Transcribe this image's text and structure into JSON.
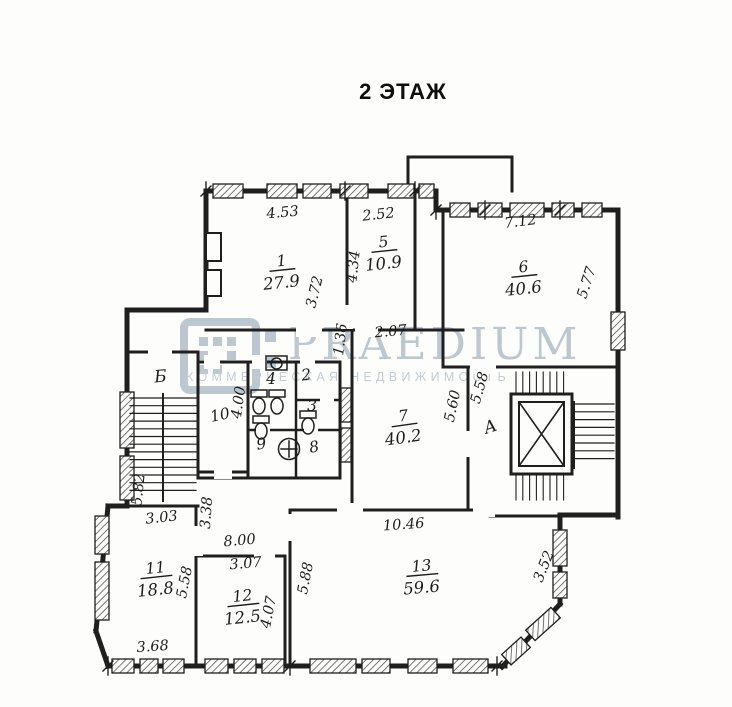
{
  "title": "2 ЭТАЖ",
  "watermark": {
    "brand": "PRAEDIUM",
    "subtitle": "КОММЕРЧЕСКАЯ НЕДВИЖИМОСТЬ",
    "color": "#b7c2cc"
  },
  "colors": {
    "ink": "#1f1f1f",
    "paper": "#fdfdfc"
  },
  "plan": {
    "rooms": [
      {
        "num": "1",
        "area": "27.9",
        "x": 282,
        "y": 266,
        "rot": -6
      },
      {
        "num": "5",
        "area": "10.9",
        "x": 384,
        "y": 247,
        "rot": -6
      },
      {
        "num": "6",
        "area": "40.6",
        "x": 524,
        "y": 272,
        "rot": -6
      },
      {
        "num": "7",
        "area": "40.2",
        "x": 404,
        "y": 421,
        "rot": -8
      },
      {
        "num": "11",
        "area": "18.8",
        "x": 156,
        "y": 573,
        "rot": -6
      },
      {
        "num": "12",
        "area": "12.5",
        "x": 243,
        "y": 601,
        "rot": -6
      },
      {
        "num": "13",
        "area": "59.6",
        "x": 422,
        "y": 571,
        "rot": -5
      },
      {
        "num": "2",
        "x": 307,
        "y": 380,
        "rot": -8
      },
      {
        "num": "3",
        "x": 312,
        "y": 411,
        "rot": 0
      },
      {
        "num": "4",
        "x": 271,
        "y": 384,
        "rot": 0
      },
      {
        "num": "8",
        "x": 315,
        "y": 452,
        "rot": -10
      },
      {
        "num": "9",
        "x": 262,
        "y": 449,
        "rot": -8
      },
      {
        "num": "10",
        "x": 221,
        "y": 420,
        "rot": -12
      }
    ],
    "dims": [
      {
        "t": "4.53",
        "x": 283,
        "y": 217,
        "r": -5
      },
      {
        "t": "2.52",
        "x": 379,
        "y": 219,
        "r": -6
      },
      {
        "t": "7.12",
        "x": 521,
        "y": 226,
        "r": -7
      },
      {
        "t": "3.72",
        "x": 319,
        "y": 293,
        "r": -76
      },
      {
        "t": "4.34",
        "x": 358,
        "y": 267,
        "r": -84
      },
      {
        "t": "5.77",
        "x": 591,
        "y": 284,
        "r": -72
      },
      {
        "t": "2.07",
        "x": 391,
        "y": 336,
        "r": -5
      },
      {
        "t": "1.36",
        "x": 345,
        "y": 340,
        "r": -83
      },
      {
        "t": "5.60",
        "x": 457,
        "y": 407,
        "r": -78
      },
      {
        "t": "5.58",
        "x": 484,
        "y": 389,
        "r": -74
      },
      {
        "t": "4.00",
        "x": 243,
        "y": 403,
        "r": -82
      },
      {
        "t": "5.82",
        "x": 143,
        "y": 490,
        "r": -84
      },
      {
        "t": "3.38",
        "x": 211,
        "y": 513,
        "r": -86
      },
      {
        "t": "3.03",
        "x": 162,
        "y": 522,
        "r": -6
      },
      {
        "t": "8.00",
        "x": 240,
        "y": 545,
        "r": -5
      },
      {
        "t": "3.07",
        "x": 246,
        "y": 568,
        "r": -5
      },
      {
        "t": "5.58",
        "x": 189,
        "y": 583,
        "r": -79
      },
      {
        "t": "3.68",
        "x": 153,
        "y": 651,
        "r": -4
      },
      {
        "t": "4.07",
        "x": 273,
        "y": 613,
        "r": -79
      },
      {
        "t": "5.88",
        "x": 310,
        "y": 579,
        "r": -79
      },
      {
        "t": "10.46",
        "x": 404,
        "y": 529,
        "r": -4
      },
      {
        "t": "3.52",
        "x": 548,
        "y": 568,
        "r": -68
      }
    ],
    "zones": [
      {
        "t": "Б",
        "x": 161,
        "y": 382,
        "r": -5
      },
      {
        "t": "А",
        "x": 492,
        "y": 432,
        "r": -18
      }
    ]
  }
}
